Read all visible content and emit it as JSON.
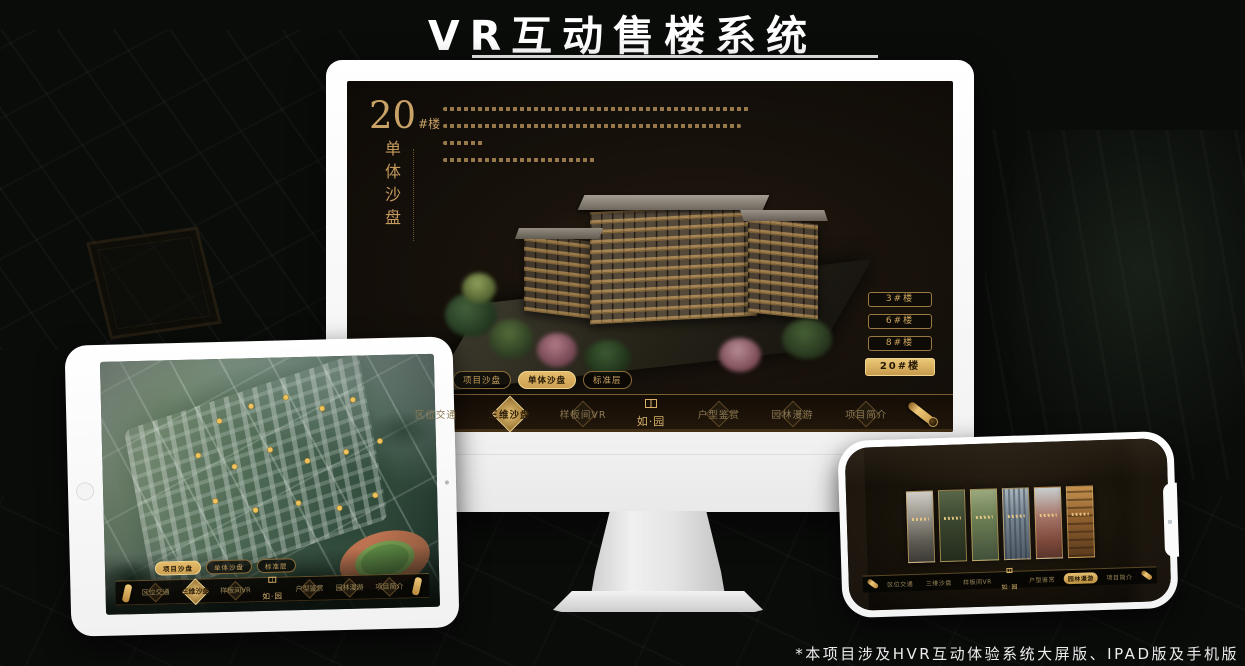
{
  "page": {
    "title": "VR互动售楼系统",
    "footnote": "*本项目涉及HVR互动体验系统大屏版、IPAD版及手机版"
  },
  "colors": {
    "background": "#0a0c0a",
    "gold": "#c9a164",
    "gold_selected": "#d9ad5c",
    "screen_bg": "#15100a",
    "title_text": "#ffffff"
  },
  "app": {
    "logo": "如·园",
    "menu": [
      "区位交通",
      "三维沙盘",
      "样板间VR",
      "户型鉴赏",
      "园林漫游",
      "项目简介"
    ],
    "sub_tabs": [
      "项目沙盘",
      "单体沙盘",
      "标准层"
    ]
  },
  "monitor": {
    "unit_number": "20",
    "unit_suffix": "#楼",
    "unit_subtitle": "单体沙盘",
    "intro_lines_count": 4,
    "floor_buttons": [
      "3#楼",
      "6#楼",
      "8#楼",
      "20#楼"
    ],
    "selected_floor": "20#楼",
    "selected_sub_tab": "单体沙盘",
    "selected_menu": "三维沙盘"
  },
  "tablet": {
    "view": "项目沙盘鸟瞰图",
    "selected_sub_tab": "项目沙盘",
    "selected_menu": "三维沙盘"
  },
  "phone": {
    "view": "场景画廊",
    "panels_count": 6,
    "selected_menu": "园林漫游"
  }
}
